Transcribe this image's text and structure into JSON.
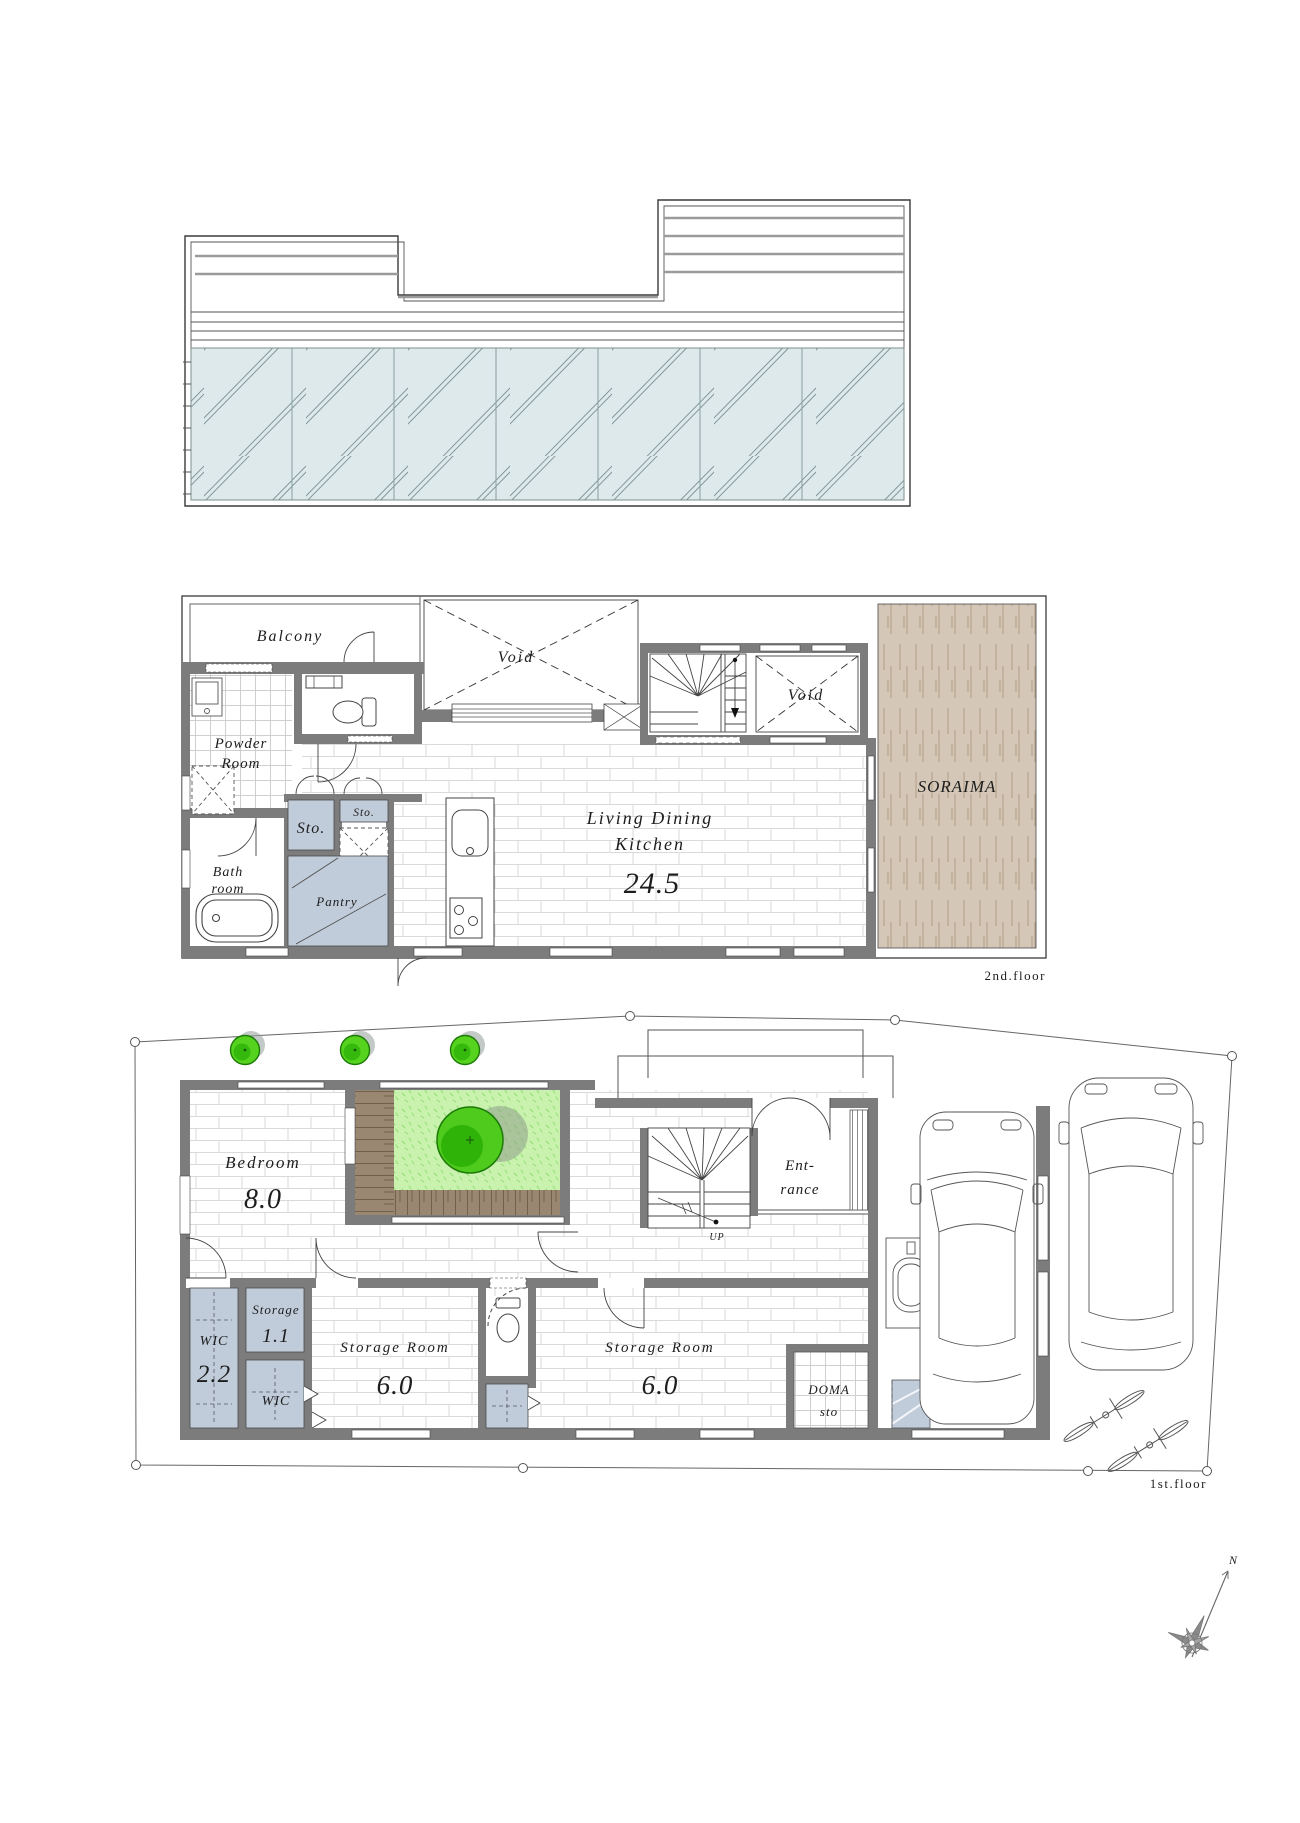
{
  "colors": {
    "wall_gray": "#7c7c7c",
    "storage_blue": "#c1ccda",
    "soraima_tan": "#d5c7b7",
    "deck_brown": "#9a8772",
    "grass_green": "#c9f2ae",
    "tree_green": "#55d31e",
    "roof_teal": "#dde9ea",
    "line_dark": "#3a3a3a"
  },
  "roof": {
    "name": "roof-plan"
  },
  "floor2": {
    "floor_label": "2nd.floor",
    "rooms": {
      "balcony": "Balcony",
      "void": "Void",
      "powder_l1": "Powder",
      "powder_l2": "Room",
      "bath_l1": "Bath",
      "bath_l2": "room",
      "sto": "Sto.",
      "pantry": "Pantry",
      "ldk_l1": "Living Dining",
      "ldk_l2": "Kitchen",
      "ldk_area": "24.5",
      "soraima": "SORAIMA"
    }
  },
  "floor1": {
    "floor_label": "1st.floor",
    "rooms": {
      "bedroom": "Bedroom",
      "bedroom_area": "8.0",
      "wic": "WIC",
      "wic_area": "2.2",
      "storage_sm": "Storage",
      "storage_sm_area": "1.1",
      "storage_room": "Storage Room",
      "storage_room_area": "6.0",
      "entrance_l1": "Ent-",
      "entrance_l2": "rance",
      "stair_up": "UP",
      "doma_l1": "DOMA",
      "doma_l2": "sto"
    }
  },
  "compass": {
    "north_label": "N"
  }
}
